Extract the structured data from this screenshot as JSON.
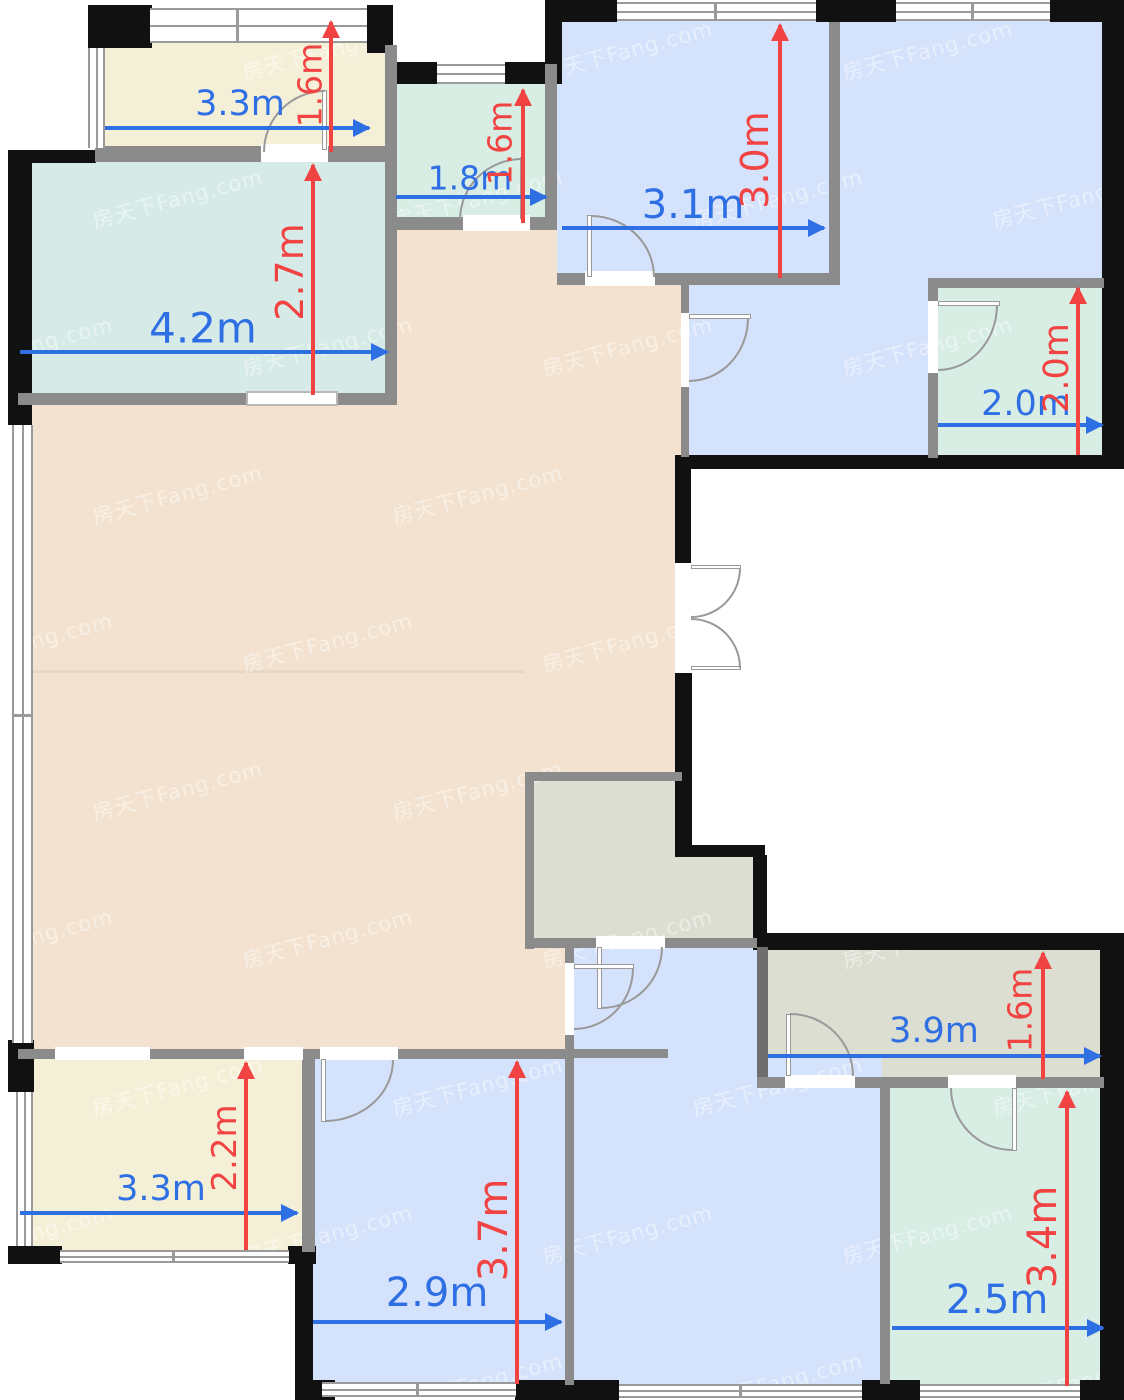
{
  "title": "apartment-floor-plan",
  "watermark": {
    "text": "房天下Fang.com"
  },
  "palette": {
    "peach": "#f3e2cf",
    "teal": "#d6ebe8",
    "mint": "#d8ede3",
    "cream": "#f4f0d8",
    "blue": "#d5e2fb",
    "gray_green": "#dcded1",
    "wall": "#8b8b8b",
    "wall_dark": "#111111",
    "window_line": "#9a9a9a",
    "arrow_blue": "#2f6fe4",
    "arrow_red": "#f24343",
    "door_line": "#999999"
  },
  "dims": {
    "balcony_top": {
      "w": "3.3m",
      "h": "1.6m"
    },
    "bedroom_left": {
      "w": "4.2m",
      "h": "2.7m"
    },
    "bath_top": {
      "w": "1.8m",
      "h": "1.6m"
    },
    "bedroom_top_right": {
      "w": "3.1m",
      "h": "3.0m"
    },
    "bath_right": {
      "w": "2.0m",
      "h": "2.0m"
    },
    "hallway": {
      "w": "3.9m",
      "h": "1.6m"
    },
    "balcony_bottom": {
      "w": "3.3m",
      "h": "2.2m"
    },
    "bedroom_bottom": {
      "w": "2.9m",
      "h": "3.7m"
    },
    "bath_bottom_right": {
      "w": "2.5m",
      "h": "3.4m"
    }
  }
}
